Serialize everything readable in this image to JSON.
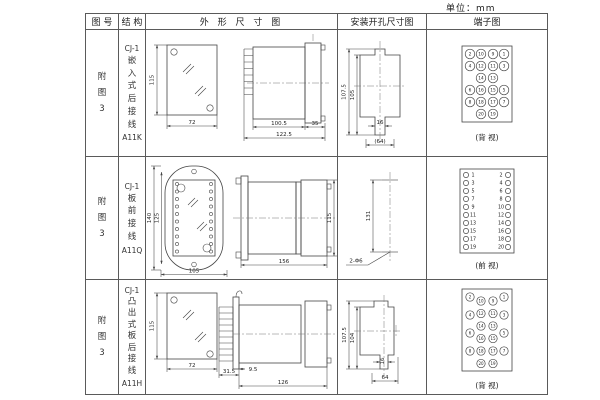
{
  "unit_label": "单位：mm",
  "colors": {
    "line": "#444444",
    "text": "#222222",
    "border": "#5a5a5a",
    "background": "#ffffff"
  },
  "table": {
    "headers": [
      "图 号",
      "结 构",
      "外 形 尺 寸 图",
      "安装开孔尺寸图",
      "端子图"
    ],
    "rows": [
      {
        "figure_no": "附图3",
        "structure": {
          "model": "CJ-1",
          "desc": "嵌入式后接线",
          "code": "A11K"
        },
        "outline": {
          "front_height": "115",
          "front_width": "72",
          "body_len": "100.5",
          "total_len": "122.5",
          "flange_len": "35"
        },
        "install": {
          "outer_height": "107.5",
          "inner_height": "105",
          "slot_width": "16",
          "hole_span": "(64)"
        },
        "terminal": {
          "caption": "(背 视)",
          "r": 4.8,
          "fs": 4.3,
          "box": [
            35,
            3,
            50,
            76
          ],
          "circles": [
            {
              "x": 43,
              "y": 11,
              "n": "2"
            },
            {
              "x": 54,
              "y": 11,
              "n": "10"
            },
            {
              "x": 66,
              "y": 11,
              "n": "9"
            },
            {
              "x": 77,
              "y": 11,
              "n": "1"
            },
            {
              "x": 43,
              "y": 23,
              "n": "4"
            },
            {
              "x": 54,
              "y": 23,
              "n": "12"
            },
            {
              "x": 66,
              "y": 23,
              "n": "11"
            },
            {
              "x": 77,
              "y": 23,
              "n": "3"
            },
            {
              "x": 54,
              "y": 35,
              "n": "14"
            },
            {
              "x": 66,
              "y": 35,
              "n": "13"
            },
            {
              "x": 43,
              "y": 47,
              "n": "6"
            },
            {
              "x": 54,
              "y": 47,
              "n": "16"
            },
            {
              "x": 66,
              "y": 47,
              "n": "15"
            },
            {
              "x": 77,
              "y": 47,
              "n": "5"
            },
            {
              "x": 43,
              "y": 59,
              "n": "8"
            },
            {
              "x": 54,
              "y": 59,
              "n": "18"
            },
            {
              "x": 66,
              "y": 59,
              "n": "17"
            },
            {
              "x": 77,
              "y": 59,
              "n": "7"
            },
            {
              "x": 54,
              "y": 71,
              "n": "20"
            },
            {
              "x": 66,
              "y": 71,
              "n": "19"
            }
          ]
        }
      },
      {
        "figure_no": "附图3",
        "structure": {
          "model": "CJ-1",
          "desc": "板前接线",
          "code": "A11Q"
        },
        "outline": {
          "front_height": "140",
          "window_height": "125",
          "front_width": "105",
          "side_length": "156",
          "side_height": "115"
        },
        "install": {
          "hole_spacing": "131",
          "holes_label": "2-Φ6"
        },
        "terminal": {
          "caption": "(前 视)",
          "r": 2.6,
          "fs": 4.8,
          "box": [
            33,
            4,
            54,
            84
          ],
          "circles": [
            {
              "x": 39,
              "lx": 46,
              "y": 10,
              "n": "1"
            },
            {
              "x": 81,
              "lx": 74,
              "y": 10,
              "n": "2"
            },
            {
              "x": 39,
              "lx": 46,
              "y": 18,
              "n": "3"
            },
            {
              "x": 81,
              "lx": 74,
              "y": 18,
              "n": "4"
            },
            {
              "x": 39,
              "lx": 46,
              "y": 26,
              "n": "5"
            },
            {
              "x": 81,
              "lx": 74,
              "y": 26,
              "n": "6"
            },
            {
              "x": 39,
              "lx": 46,
              "y": 34,
              "n": "7"
            },
            {
              "x": 81,
              "lx": 74,
              "y": 34,
              "n": "8"
            },
            {
              "x": 39,
              "lx": 46,
              "y": 42,
              "n": "9"
            },
            {
              "x": 81,
              "lx": 74,
              "y": 42,
              "n": "10"
            },
            {
              "x": 39,
              "lx": 46,
              "y": 50,
              "n": "11"
            },
            {
              "x": 81,
              "lx": 74,
              "y": 50,
              "n": "12"
            },
            {
              "x": 39,
              "lx": 46,
              "y": 58,
              "n": "13"
            },
            {
              "x": 81,
              "lx": 74,
              "y": 58,
              "n": "14"
            },
            {
              "x": 39,
              "lx": 46,
              "y": 66,
              "n": "15"
            },
            {
              "x": 81,
              "lx": 74,
              "y": 66,
              "n": "16"
            },
            {
              "x": 39,
              "lx": 46,
              "y": 74,
              "n": "17"
            },
            {
              "x": 81,
              "lx": 74,
              "y": 74,
              "n": "18"
            },
            {
              "x": 39,
              "lx": 46,
              "y": 82,
              "n": "19"
            },
            {
              "x": 81,
              "lx": 74,
              "y": 82,
              "n": "20"
            }
          ]
        }
      },
      {
        "figure_no": "附图3",
        "structure": {
          "model": "CJ-1",
          "desc": "凸出式板后接线",
          "code": "A11H"
        },
        "outline": {
          "front_height": "115",
          "front_width": "72",
          "fin_depth": "31.5",
          "panel_offset": "9.5",
          "total_len": "126"
        },
        "install": {
          "outer_height": "107.5",
          "inner_height": "104",
          "slot_width": "16",
          "hole_span": "64"
        },
        "terminal": {
          "caption": "(背 视)",
          "r": 4.2,
          "fs": 4.0,
          "box": [
            35,
            6,
            50,
            82
          ],
          "circles": [
            {
              "x": 43,
              "y": 14,
              "n": "2"
            },
            {
              "x": 77,
              "y": 14,
              "n": "1"
            },
            {
              "x": 54,
              "y": 18,
              "n": "10"
            },
            {
              "x": 66,
              "y": 18,
              "n": "9"
            },
            {
              "x": 54,
              "y": 30.5,
              "n": "12"
            },
            {
              "x": 66,
              "y": 30.5,
              "n": "11"
            },
            {
              "x": 43,
              "y": 32,
              "n": "4"
            },
            {
              "x": 77,
              "y": 32,
              "n": "3"
            },
            {
              "x": 54,
              "y": 43,
              "n": "14"
            },
            {
              "x": 66,
              "y": 43,
              "n": "13"
            },
            {
              "x": 43,
              "y": 50,
              "n": "6"
            },
            {
              "x": 77,
              "y": 50,
              "n": "5"
            },
            {
              "x": 54,
              "y": 55.5,
              "n": "16"
            },
            {
              "x": 66,
              "y": 55.5,
              "n": "15"
            },
            {
              "x": 43,
              "y": 68,
              "n": "8"
            },
            {
              "x": 77,
              "y": 68,
              "n": "7"
            },
            {
              "x": 54,
              "y": 68,
              "n": "18"
            },
            {
              "x": 66,
              "y": 68,
              "n": "17"
            },
            {
              "x": 54,
              "y": 80.5,
              "n": "20"
            },
            {
              "x": 66,
              "y": 80.5,
              "n": "19"
            }
          ]
        }
      }
    ]
  }
}
